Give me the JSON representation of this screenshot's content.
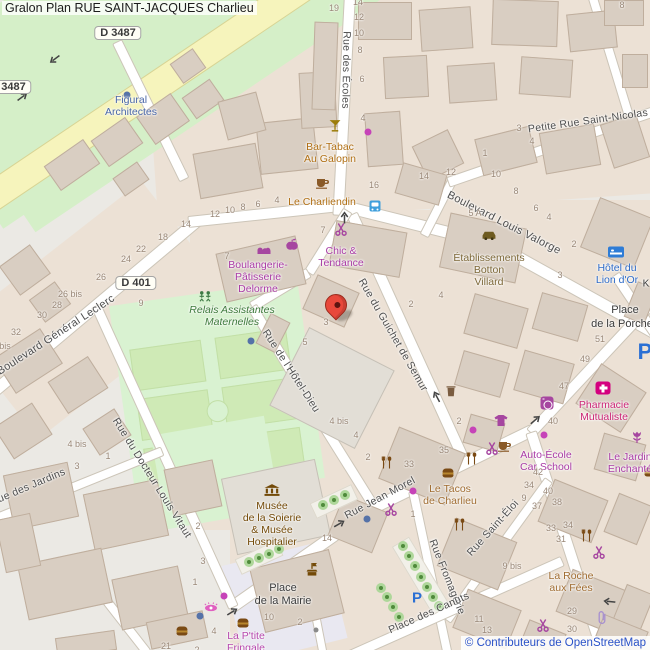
{
  "title": "Gralon Plan RUE SAINT-JACQUES Charlieu",
  "attribution": "© Contributeurs de OpenStreetMap",
  "road_refs": {
    "d3487": "D 3487",
    "d401": "D 401"
  },
  "parking_label": "P",
  "partial_label": "K",
  "streets": [
    "Rue des Écoles",
    "Petite Rue Saint-Nicolas",
    "Boulevard Louis Valorge",
    "Boulevard Général Leclerc",
    "Rue du Guichet de Semur",
    "Rue de l'Hôtel-Dieu",
    "Rue du Docteur Louis Vitaut",
    "Rue des Jardins",
    "Rue Jean Morel",
    "Rue Fromagerie",
    "Rue Saint-Éloi",
    "Place des Canuts"
  ],
  "places": {
    "mairie": [
      "Place",
      "de la Mairie"
    ],
    "porcherie": [
      "Place",
      "de la Porche"
    ]
  },
  "pois": {
    "figural": [
      "Figural",
      "Architectes"
    ],
    "bar_galopin": [
      "Bar-Tabac",
      "Au Galopin"
    ],
    "charliendin": "Le Charliendin",
    "chic_tendance": [
      "Chic &",
      "Tendance"
    ],
    "botton": [
      "Établissements",
      "Botton",
      "Villard"
    ],
    "hotel_lion": [
      "Hôtel du",
      "Lion d'Or"
    ],
    "boulangerie": [
      "Boulangerie-",
      "Pâtisserie",
      "Delorme"
    ],
    "relais": [
      "Relais Assistantes",
      "Maternelles"
    ],
    "musee": [
      "Musée",
      "de la Soierie",
      "& Musée",
      "Hospitalier"
    ],
    "pharmacie": [
      "Pharmacie",
      "Mutualiste"
    ],
    "jardin_enchante": [
      "Le Jardin",
      "Enchanté"
    ],
    "auto_ecole": [
      "Auto-École",
      "Car School"
    ],
    "tacos": [
      "Le Tacos",
      "de Charlieu"
    ],
    "roche_fees": [
      "La Roche",
      "aux Fées"
    ],
    "fringale": [
      "La P'tite",
      "Fringale"
    ]
  },
  "housenumbers": [
    "19",
    "14",
    "12",
    "10",
    "8",
    "6",
    "4",
    "8",
    "3",
    "4",
    "1",
    "16",
    "14",
    "12",
    "10",
    "8",
    "6",
    "4",
    "2",
    "5 A",
    "3",
    "14",
    "12",
    "10",
    "8",
    "6",
    "4",
    "18",
    "22",
    "24",
    "26",
    "26 bis",
    "28",
    "30",
    "32",
    "bis",
    "9",
    "7",
    "3",
    "5",
    "2",
    "4",
    "4 bis",
    "4",
    "35",
    "33",
    "2",
    "4 bis",
    "3",
    "1",
    "2",
    "3",
    "1",
    "2",
    "51",
    "49",
    "47",
    "40",
    "42",
    "34",
    "40",
    "9",
    "37",
    "38",
    "33",
    "34",
    "31",
    "9 bis",
    "11",
    "13",
    "29",
    "30",
    "1",
    "14",
    "10",
    "2",
    "4",
    "21",
    "2",
    "7"
  ],
  "colors": {
    "marker_red": "#e8483b",
    "road_yellow": "#f6f4bc",
    "park_green": "#d9f2d1",
    "building": "#d9cec2",
    "shop_magenta": "#a646a0",
    "food_brown": "#a06c30",
    "tourism_brown": "#734a08",
    "hotel_blue": "#2e6bc8",
    "office_blue": "#4a67a8",
    "parking_blue": "#2a6fd4",
    "pharmacy_pink": "#d4007f"
  }
}
